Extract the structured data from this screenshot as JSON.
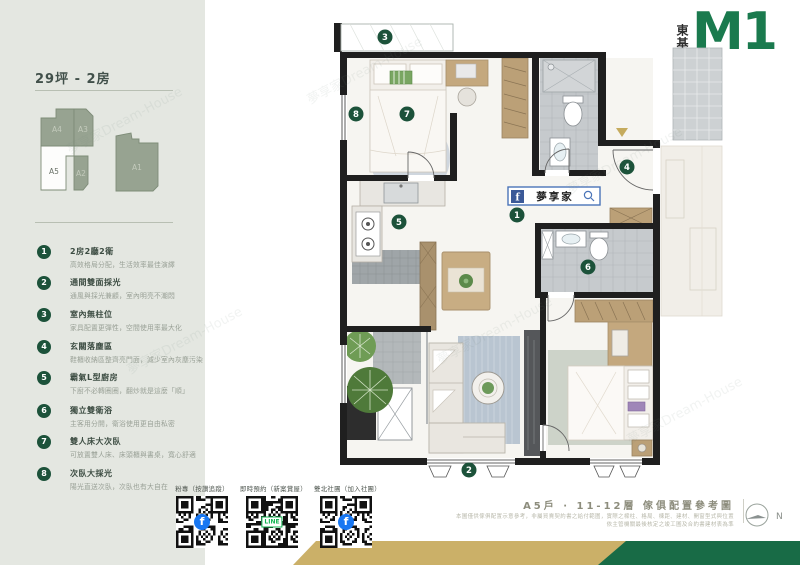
{
  "sidebar": {
    "title": "29坪 - 2房",
    "keyplan": {
      "units": [
        "A4",
        "A3",
        "A5",
        "A2",
        "A1"
      ]
    },
    "features": [
      {
        "num": "1",
        "title": "2房2廳2衛",
        "desc": "高效格局分配，生活效率最佳演繹"
      },
      {
        "num": "2",
        "title": "通間雙面採光",
        "desc": "通風與採光兼顧，室內明亮不潮悶"
      },
      {
        "num": "3",
        "title": "室內無柱位",
        "desc": "家具配置更彈性，空間使用率最大化"
      },
      {
        "num": "4",
        "title": "玄關落塵區",
        "desc": "鞋櫃收納區整齊亮門面，減少室內灰塵污染"
      },
      {
        "num": "5",
        "title": "霸氣L型廚房",
        "desc": "下廚不必轉圈圈，翻炒就是這麼「順」"
      },
      {
        "num": "6",
        "title": "獨立雙衛浴",
        "desc": "主客用分開，衛浴使用更自由私密"
      },
      {
        "num": "7",
        "title": "雙人床大次臥",
        "desc": "可放置雙人床、床頭櫃與書桌，寬心舒適"
      },
      {
        "num": "8",
        "title": "次臥大採光",
        "desc": "陽光直送次臥，次臥也有大自在"
      }
    ]
  },
  "logo": {
    "brand": "東基",
    "mark": "M1",
    "name": "M1"
  },
  "plan": {
    "fb_banner": "夢享家",
    "markers": [
      "1",
      "2",
      "3",
      "4",
      "5",
      "6",
      "7",
      "8"
    ]
  },
  "footer": {
    "qr": [
      {
        "label": "粉專（按讚追蹤）",
        "logo": "facebook"
      },
      {
        "label": "即時預約（新案賞屋）",
        "logo": "line"
      },
      {
        "label": "雙北社團（加入社團）",
        "logo": "facebook"
      }
    ],
    "caption": "A5戶 · 11-12層 傢俱配置參考圖",
    "disclaimer1": "本圖僅供傢俱配置示意參考，非屬買賣契約書之給付範圍，實際之樑柱、格局、棟距、建材、開窗型式與位置",
    "disclaimer2": "依主管機關最後核定之竣工圖及合約書建材表為準",
    "compass_label": "N"
  },
  "watermark": "夢享家Dream-House",
  "colors": {
    "sidebar_bg": "#e4e7e1",
    "brand_green": "#1a7a4e",
    "marker_green": "#1c523a",
    "gold": "#cbb068",
    "band_green": "#186b46",
    "wall_black": "#1f1f1f",
    "fb_blue": "#3b5998"
  }
}
